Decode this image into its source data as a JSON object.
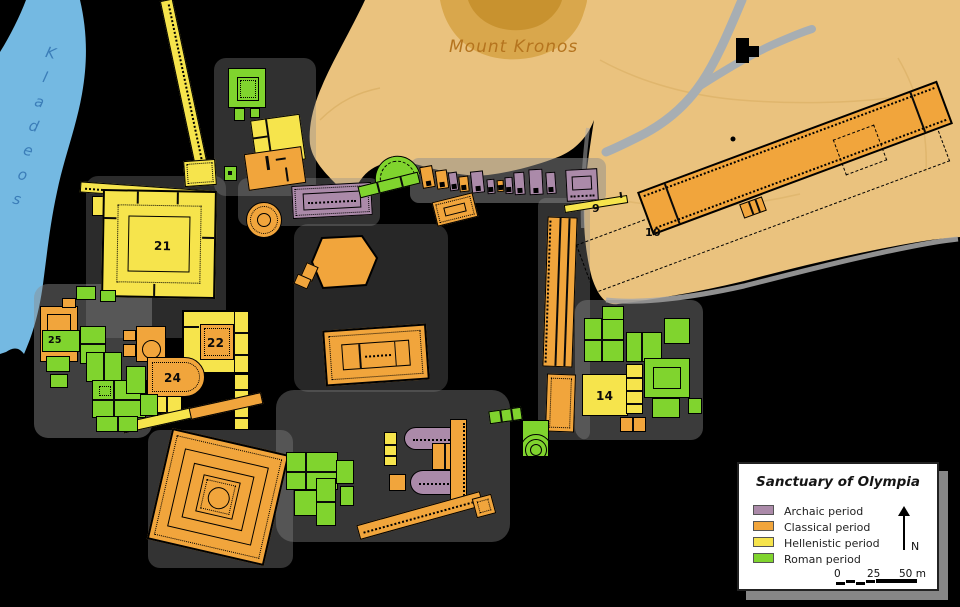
{
  "legend": {
    "title": "Sanctuary of Olympia",
    "items": [
      {
        "label": "Archaic period",
        "color": "#ab8aa9",
        "period": "archaic"
      },
      {
        "label": "Classical period",
        "color": "#f1a53c",
        "period": "classical"
      },
      {
        "label": "Hellenistic period",
        "color": "#f6e44c",
        "period": "hellenistic"
      },
      {
        "label": "Roman period",
        "color": "#80d42e",
        "period": "roman"
      }
    ]
  },
  "map_labels": {
    "mount_kronos": "Mount Kronos",
    "kladeos_river": "Kladeos"
  },
  "building_numbers": {
    "n9": "9",
    "n10": "10",
    "n14": "14",
    "n21": "21",
    "n22": "22",
    "n24": "24",
    "n25": "25"
  },
  "compass": {
    "north_label": "N"
  },
  "scale_bar": {
    "tick_0": "0",
    "tick_25": "25",
    "tick_50": "50 m"
  },
  "colors": {
    "archaic": "#ab8aa9",
    "classical": "#f1a53c",
    "hellenistic": "#f6e44c",
    "roman": "#80d42e",
    "background": "#000000",
    "river": "#74b9e2",
    "river_label": "#3b7db8",
    "hill": "#eac27e",
    "hill_mid": "#d9a74c",
    "hill_dark": "#c8922f",
    "hill_label": "#b5741e",
    "ground": "#8d8d8d",
    "road": "#a7aeb3"
  }
}
